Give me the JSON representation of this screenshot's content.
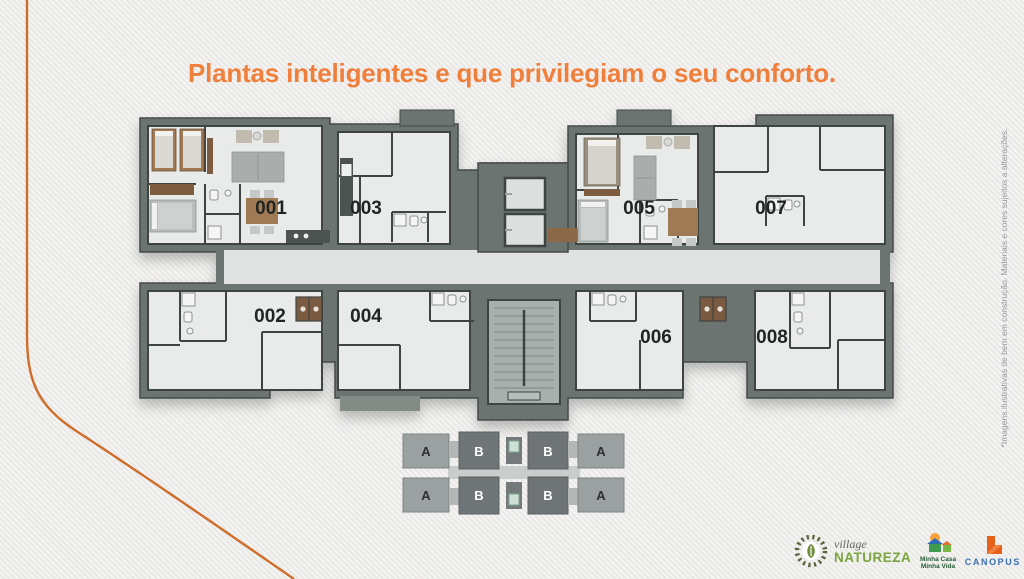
{
  "title": {
    "text": "Plantas inteligentes e que privilegiam o seu conforto."
  },
  "floor_plan": {
    "units": [
      {
        "id": "001",
        "wing": "top-left",
        "furnished": true
      },
      {
        "id": "002",
        "wing": "bottom-left",
        "furnished": false
      },
      {
        "id": "003",
        "wing": "top-left-center",
        "furnished": false
      },
      {
        "id": "004",
        "wing": "bottom-left-center",
        "furnished": false
      },
      {
        "id": "005",
        "wing": "top-right-center",
        "furnished": true
      },
      {
        "id": "006",
        "wing": "bottom-right-center",
        "furnished": false
      },
      {
        "id": "007",
        "wing": "top-right",
        "furnished": false
      },
      {
        "id": "008",
        "wing": "bottom-right",
        "furnished": false
      }
    ],
    "core": {
      "elevators": 2,
      "stairs": 1
    }
  },
  "key_plan": {
    "top": [
      "A",
      "B",
      "B",
      "A"
    ],
    "bottom": [
      "A",
      "B",
      "B",
      "A"
    ]
  },
  "disclaimer": {
    "text": "*Imagens ilustrativas de bem em construção. Materiais e cores sujeitos a alterações."
  },
  "logos": {
    "village": {
      "script": "village",
      "name": "NATUREZA"
    },
    "mcmv": {
      "line1": "Minha Casa",
      "line2": "Minha Vida"
    },
    "canopus": {
      "name": "CANOPUS"
    }
  },
  "colors": {
    "accent_orange": "#f07f3c",
    "curve_orange": "#cf6d2a",
    "wall_fill": "#6b7470",
    "wall_line": "#3e4441",
    "floor": "#e9ebea",
    "corridor": "#dfe2e1",
    "stairs": "#a8afac",
    "keyplan_a": "#9ba1a1",
    "keyplan_b": "#6f7476",
    "natureza_green": "#79a43e",
    "mcmv_green": "#265c35",
    "canopus_blue": "#3a6fb5",
    "canopus_orange": "#e8611b"
  }
}
